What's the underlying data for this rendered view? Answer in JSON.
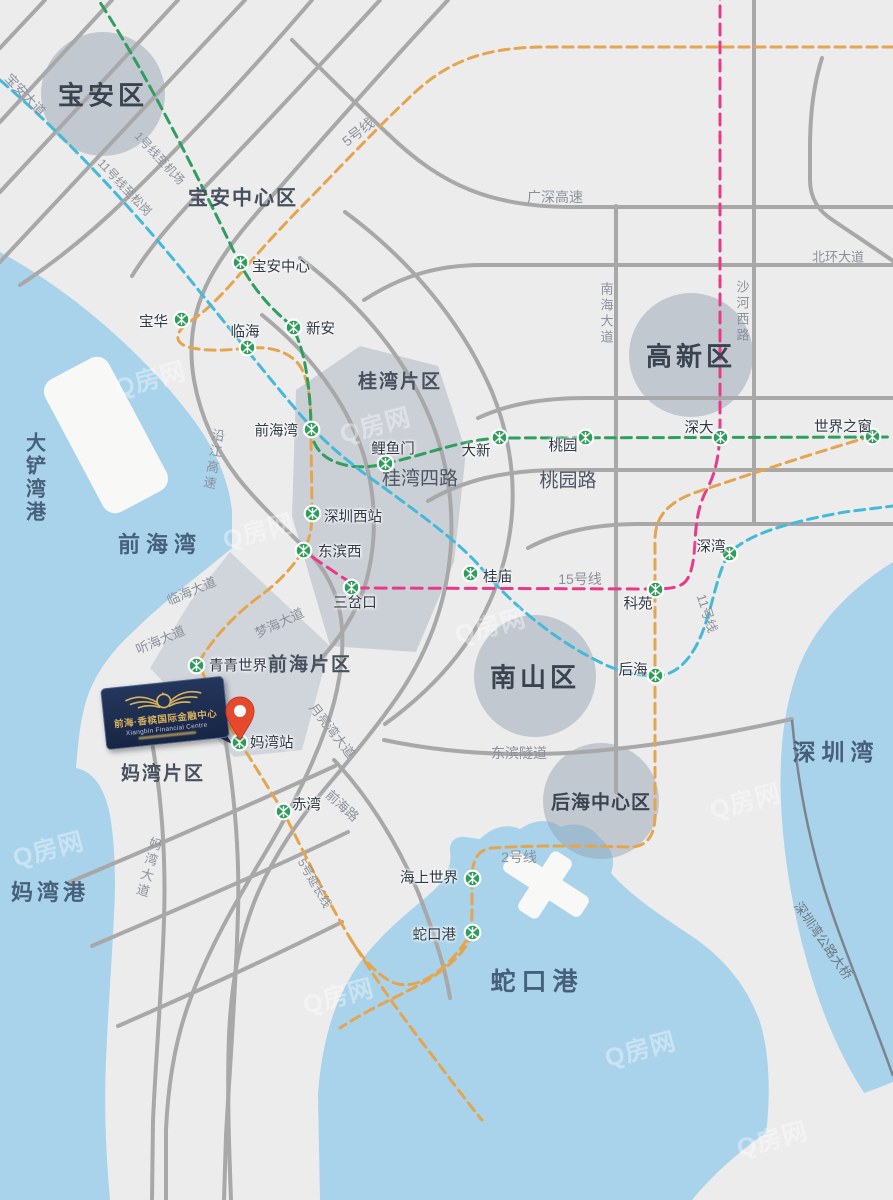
{
  "map": {
    "colors": {
      "water": "#a9d3ea",
      "land": "#ececec",
      "pier": "#f8f8f6",
      "road": "#a8a8a8",
      "bridge": "#7d848e",
      "line1_green": "#2f9e5e",
      "line5_orange": "#e5a54f",
      "line11_cyan": "#44b9d9",
      "line15_pink": "#e73b8a",
      "station_green": "#2d9d5a",
      "pin_red": "#e64a2e",
      "logo_navy": "#1e2f52",
      "logo_gold": "#d6b15e"
    },
    "logo": {
      "line1": "前海·香槟国际金融中心",
      "line2": "Xiangbin Financial Centre"
    },
    "watermark_text": "Q房网",
    "watermarks": [
      {
        "x": 150,
        "y": 378
      },
      {
        "x": 375,
        "y": 424
      },
      {
        "x": 258,
        "y": 530
      },
      {
        "x": 490,
        "y": 625
      },
      {
        "x": 48,
        "y": 848
      },
      {
        "x": 338,
        "y": 995
      },
      {
        "x": 745,
        "y": 800
      },
      {
        "x": 640,
        "y": 1048
      },
      {
        "x": 772,
        "y": 1138
      }
    ],
    "districts": [
      {
        "label": "宝安区",
        "x": 103,
        "y": 94,
        "r": 62,
        "size": 26
      },
      {
        "label": "高新区",
        "x": 691,
        "y": 355,
        "r": 62,
        "size": 26
      },
      {
        "label": "南山区",
        "x": 535,
        "y": 676,
        "r": 61,
        "size": 26
      },
      {
        "label": "后海中心区",
        "x": 601,
        "y": 801,
        "r": 58,
        "size": 19
      }
    ],
    "water_labels": [
      {
        "label": "前海湾",
        "x": 160,
        "y": 543,
        "size": 22,
        "ls": 6
      },
      {
        "label": "大铲湾港",
        "x": 34,
        "y": 478,
        "size": 20,
        "vert": true
      },
      {
        "label": "妈湾港",
        "x": 50,
        "y": 891,
        "size": 22,
        "ls": 4
      },
      {
        "label": "蛇口港",
        "x": 537,
        "y": 980,
        "size": 25,
        "ls": 6
      },
      {
        "label": "深圳湾",
        "x": 836,
        "y": 750,
        "size": 23,
        "ls": 6
      }
    ],
    "area_labels": [
      {
        "label": "宝安中心区",
        "x": 243,
        "y": 196,
        "size": 20
      },
      {
        "label": "桂湾片区",
        "x": 400,
        "y": 380,
        "size": 19
      },
      {
        "label": "前海片区",
        "x": 310,
        "y": 663,
        "size": 19
      },
      {
        "label": "妈湾片区",
        "x": 163,
        "y": 772,
        "size": 19
      }
    ],
    "road_labels": [
      {
        "label": "宝安大道",
        "x": 26,
        "y": 94,
        "rot": 47
      },
      {
        "label": "1号线至机场",
        "x": 160,
        "y": 158,
        "rot": 47,
        "size": 12
      },
      {
        "label": "11号线至松岗",
        "x": 125,
        "y": 187,
        "rot": 47,
        "size": 12
      },
      {
        "label": "5号线",
        "x": 358,
        "y": 132,
        "rot": -38,
        "size": 14
      },
      {
        "label": "广深高速",
        "x": 555,
        "y": 197,
        "size": 14
      },
      {
        "label": "北环大道",
        "x": 838,
        "y": 256,
        "size": 13
      },
      {
        "label": "南海大道",
        "x": 606,
        "y": 314,
        "vert": true
      },
      {
        "label": "沙河西路",
        "x": 742,
        "y": 312,
        "vert": true
      },
      {
        "label": "沿江高速",
        "x": 213,
        "y": 460,
        "vert": true,
        "rot": 10
      },
      {
        "label": "临海大道",
        "x": 191,
        "y": 590,
        "rot": -23
      },
      {
        "label": "听海大道",
        "x": 160,
        "y": 639,
        "rot": -23
      },
      {
        "label": "梦海大道",
        "x": 279,
        "y": 622,
        "rot": -25
      },
      {
        "label": "月亮湾大道",
        "x": 333,
        "y": 730,
        "rot": 52
      },
      {
        "label": "前海路",
        "x": 343,
        "y": 805,
        "rot": 42
      },
      {
        "label": "妈湾大道",
        "x": 148,
        "y": 868,
        "vert": true,
        "rot": 15
      },
      {
        "label": "东滨隧道",
        "x": 519,
        "y": 753,
        "size": 14
      },
      {
        "label": "15号线",
        "x": 580,
        "y": 579,
        "size": 14
      },
      {
        "label": "11号线",
        "x": 708,
        "y": 613,
        "rot": 72
      },
      {
        "label": "2号线",
        "x": 519,
        "y": 857,
        "size": 14
      },
      {
        "label": "5号延长线",
        "x": 315,
        "y": 883,
        "rot": 60,
        "size": 12
      },
      {
        "label": "深圳湾公路大桥",
        "x": 824,
        "y": 940,
        "rot": 55,
        "color": "#6e7680"
      },
      {
        "label": "桂湾四路",
        "x": 420,
        "y": 477,
        "size": 19,
        "dark": true
      },
      {
        "label": "桃园路",
        "x": 568,
        "y": 479,
        "size": 19,
        "dark": true
      }
    ],
    "stations": [
      {
        "label": "宝安中心",
        "x": 240,
        "y": 262,
        "lx": 252,
        "ly": 266,
        "anchor": "start"
      },
      {
        "label": "宝华",
        "x": 181,
        "y": 319,
        "lx": 168,
        "ly": 321,
        "anchor": "end"
      },
      {
        "label": "临海",
        "x": 247,
        "y": 347,
        "lx": 245,
        "ly": 331,
        "anchor": "middle"
      },
      {
        "label": "新安",
        "x": 293,
        "y": 327,
        "lx": 306,
        "ly": 328,
        "anchor": "start"
      },
      {
        "label": "前海湾",
        "x": 311,
        "y": 429,
        "lx": 298,
        "ly": 430,
        "anchor": "end"
      },
      {
        "label": "鲤鱼门",
        "x": 385,
        "y": 463,
        "lx": 393,
        "ly": 448,
        "anchor": "middle"
      },
      {
        "label": "大新",
        "x": 499,
        "y": 437,
        "lx": 476,
        "ly": 450,
        "anchor": "middle"
      },
      {
        "label": "桃园",
        "x": 585,
        "y": 437,
        "lx": 563,
        "ly": 445,
        "anchor": "middle"
      },
      {
        "label": "深大",
        "x": 720,
        "y": 437,
        "lx": 699,
        "ly": 427,
        "anchor": "middle"
      },
      {
        "label": "世界之窗",
        "x": 872,
        "y": 436,
        "lx": 843,
        "ly": 426,
        "anchor": "middle"
      },
      {
        "label": "深圳西站",
        "x": 312,
        "y": 513,
        "lx": 324,
        "ly": 516,
        "anchor": "start"
      },
      {
        "label": "东滨西",
        "x": 303,
        "y": 550,
        "lx": 318,
        "ly": 551,
        "anchor": "start"
      },
      {
        "label": "三岔口",
        "x": 351,
        "y": 587,
        "lx": 355,
        "ly": 602,
        "anchor": "middle"
      },
      {
        "label": "桂庙",
        "x": 470,
        "y": 573,
        "lx": 483,
        "ly": 576,
        "anchor": "start"
      },
      {
        "label": "科苑",
        "x": 655,
        "y": 589,
        "lx": 638,
        "ly": 603,
        "anchor": "middle"
      },
      {
        "label": "后海",
        "x": 655,
        "y": 675,
        "lx": 633,
        "ly": 669,
        "anchor": "middle"
      },
      {
        "label": "深湾",
        "x": 729,
        "y": 553,
        "lx": 711,
        "ly": 546,
        "anchor": "middle"
      },
      {
        "label": "青青世界",
        "x": 196,
        "y": 665,
        "lx": 209,
        "ly": 665,
        "anchor": "start"
      },
      {
        "label": "妈湾站",
        "x": 239,
        "y": 742,
        "lx": 250,
        "ly": 742,
        "anchor": "start"
      },
      {
        "label": "赤湾",
        "x": 283,
        "y": 811,
        "lx": 292,
        "ly": 804,
        "anchor": "start"
      },
      {
        "label": "海上世界",
        "x": 472,
        "y": 878,
        "lx": 458,
        "ly": 877,
        "anchor": "end"
      },
      {
        "label": "蛇口港",
        "x": 472,
        "y": 932,
        "lx": 456,
        "ly": 934,
        "anchor": "end"
      }
    ]
  }
}
